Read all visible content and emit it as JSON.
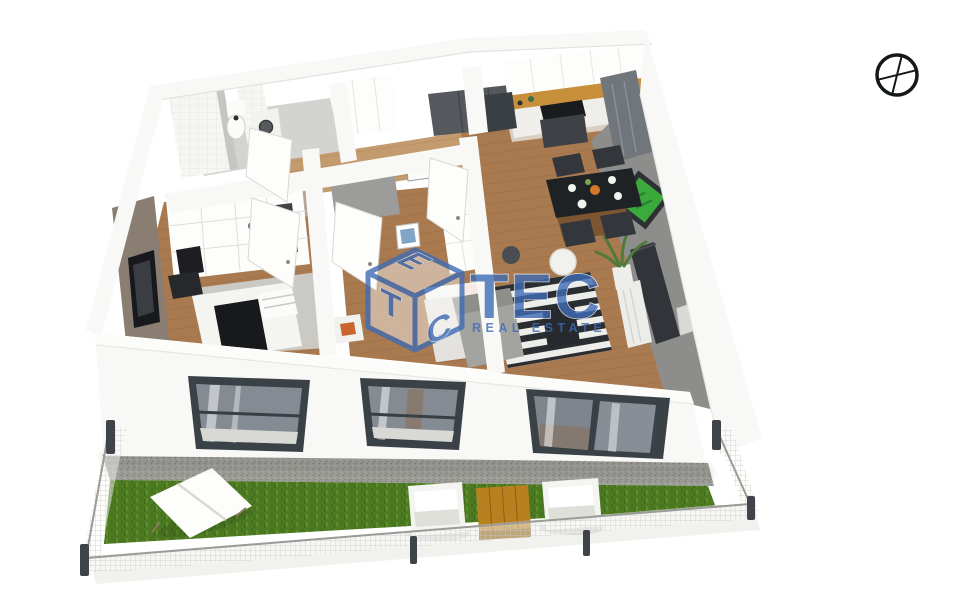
{
  "watermark": {
    "brand": "TEC",
    "subtitle": "REAL ESTATE",
    "cube": {
      "top": "E",
      "left": "T",
      "right": "C"
    }
  },
  "compass": {
    "icon": "compass-crosshair-icon"
  },
  "palette": {
    "brand_blue": "#3F6CB4",
    "wall_white": "#F8F8F6",
    "gray_wall": "#8D8D8C",
    "taupe_wall": "#8A7D72",
    "greige_wall": "#B3A698",
    "wood_floor": "#A97A50",
    "hall_wood": "#C49B6E",
    "kitchen_wood": "#C78F3A",
    "frame_dark": "#3A4147",
    "glass_gray": "#848B92",
    "grass_green": "#4C7A21",
    "gravel_gray": "#9C9C97",
    "rug_dark": "#2A2E33",
    "rug_light": "#EDEDEA",
    "black": "#1F2225",
    "table_wood": "#B9801F",
    "art_green": "#3BAA3C",
    "pillow_pink": "#DE9A8C",
    "post_dark": "#3E444A"
  }
}
